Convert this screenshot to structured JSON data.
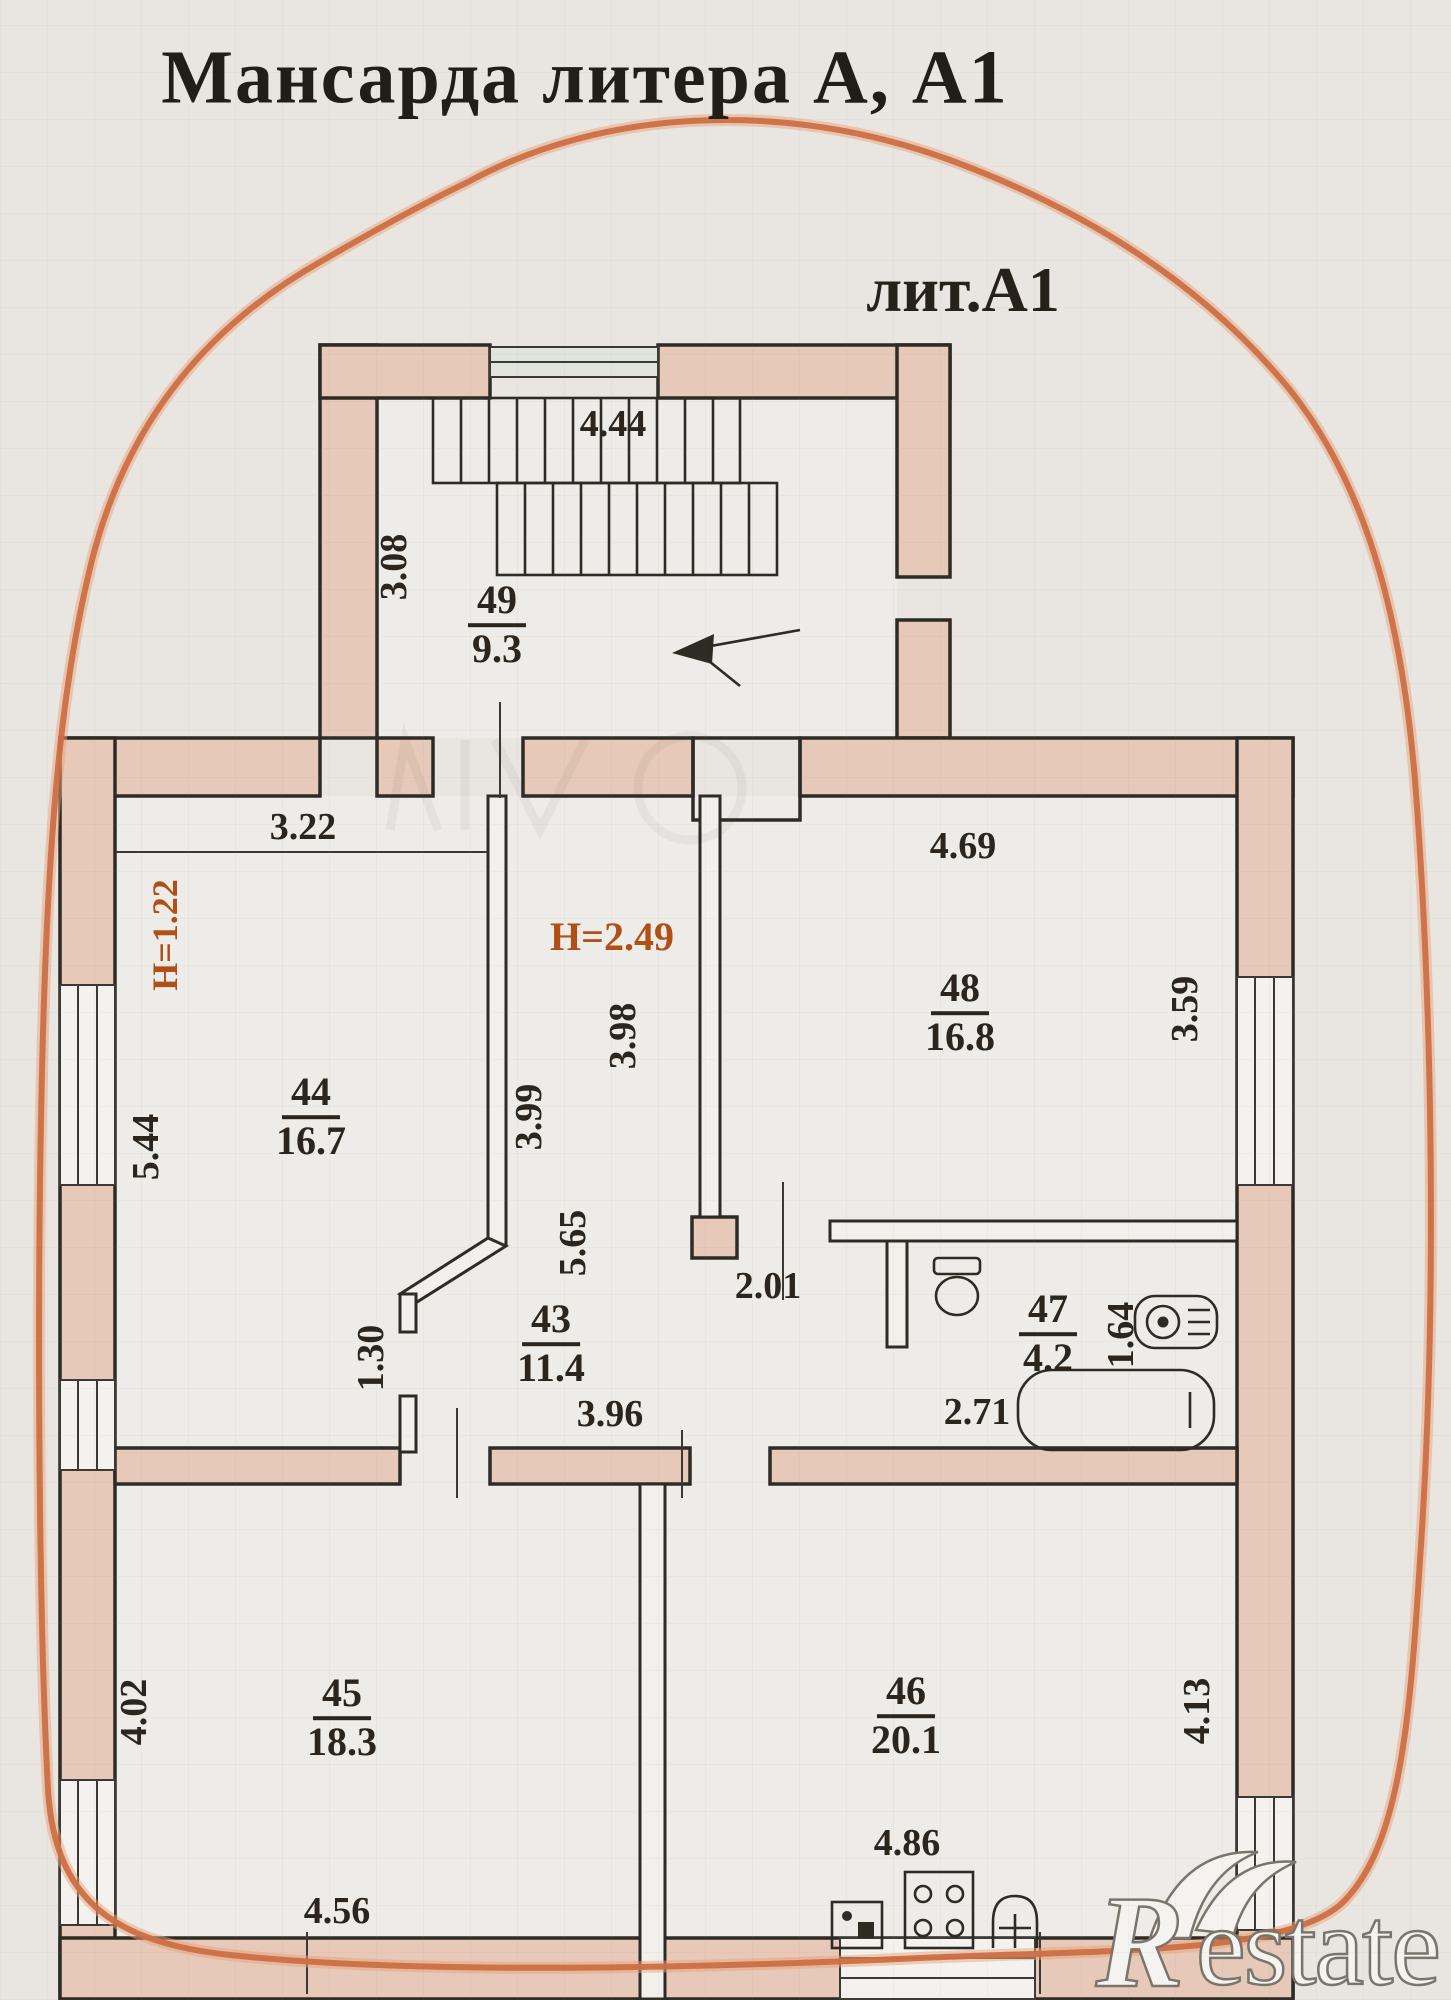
{
  "title": "Мансарда литера А, А1",
  "floor_label": "лит.А1",
  "rooms": {
    "r49": {
      "number": "49",
      "area": "9.3"
    },
    "r44": {
      "number": "44",
      "area": "16.7"
    },
    "r43": {
      "number": "43",
      "area": "11.4"
    },
    "r48": {
      "number": "48",
      "area": "16.8"
    },
    "r47": {
      "number": "47",
      "area": "4.2"
    },
    "r45": {
      "number": "45",
      "area": "18.3"
    },
    "r46": {
      "number": "46",
      "area": "20.1"
    }
  },
  "dims": {
    "d444": "4.44",
    "d308": "3.08",
    "d322": "3.22",
    "d469": "4.69",
    "d398": "3.98",
    "d399": "3.99",
    "d544": "5.44",
    "d359": "3.59",
    "d565": "5.65",
    "d201": "2.01",
    "d130": "1.30",
    "d396": "3.96",
    "d164": "1.64",
    "d271": "2.71",
    "d402": "4.02",
    "d413": "4.13",
    "d486": "4.86",
    "d456": "4.56"
  },
  "heights": {
    "h122": "Н=1.22",
    "h249": "Н=2.49"
  },
  "watermark": {
    "initial": "R",
    "rest": "estate"
  },
  "icons": [
    "toilet-icon",
    "boiler-icon",
    "bathtub-icon",
    "kitchen-sink-icon",
    "stove-icon",
    "water-heater-icon",
    "stair-direction-arrow-icon"
  ],
  "colors": {
    "wall_fill": "#e6c9b8",
    "line": "#2e2a24",
    "outline_orange": "#cc6f44",
    "height_mark": "#b05016",
    "paper": "#e9e6e2"
  }
}
